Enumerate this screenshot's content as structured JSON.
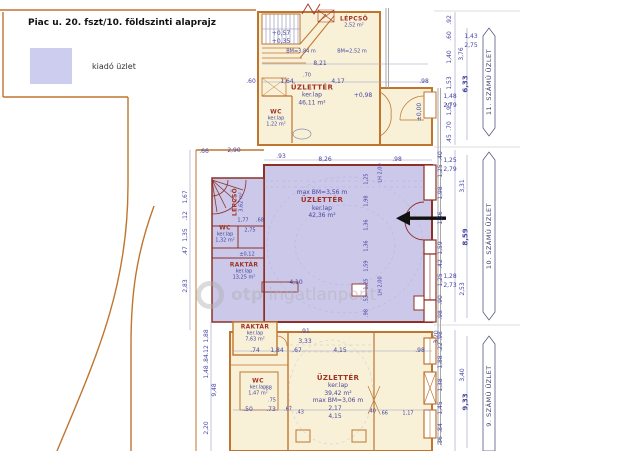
{
  "legend": {
    "title_bold": "Piac u. 20. fszt/10.",
    "title_rest": "földszinti alaprajz",
    "swatch_label": "kiadó üzlet",
    "swatch_color": "#cdcdf0"
  },
  "watermark": {
    "text_bold": "otp",
    "text_rest": "ingatlanpont"
  },
  "colors": {
    "highlight_fill": "#cbc8e9",
    "room_fill": "#f8f1d7",
    "wall_orange": "#c0752f",
    "wall_red": "#8e3026",
    "dim_blue": "#4646a0",
    "room_name_red": "#a03428",
    "facade_gray": "#a0a0a0"
  },
  "side_labels": [
    {
      "t": "11. SZÁMÚ ÜZLET",
      "x": 489,
      "y": 82
    },
    {
      "t": "10. SZÁMÚ ÜZLET",
      "x": 489,
      "y": 236
    },
    {
      "t": "9. SZÁMÚ ÜZLET",
      "x": 489,
      "y": 396
    }
  ],
  "room_labels": [
    {
      "x": 354,
      "y": 22,
      "lines": [
        {
          "t": "LÉPCSŐ",
          "c": "rn t6"
        },
        {
          "t": "2,52 m²",
          "c": "rs t5"
        }
      ]
    },
    {
      "x": 312,
      "y": 95,
      "lines": [
        {
          "t": "ÜZLETTÉR",
          "c": "rn"
        },
        {
          "t": "ker.lap",
          "c": "rs"
        },
        {
          "t": "46,11 m²",
          "c": "rs"
        }
      ]
    },
    {
      "x": 276,
      "y": 118,
      "lines": [
        {
          "t": "WC",
          "c": "rn t6"
        },
        {
          "t": "ker.lap",
          "c": "rs t5"
        },
        {
          "t": "1,22 m²",
          "c": "rs t5"
        }
      ]
    },
    {
      "x": 238,
      "y": 202,
      "r": 1,
      "lines": [
        {
          "t": "LÉPCSŐ",
          "c": "rn t6"
        },
        {
          "t": "3,62 m²",
          "c": "rs t5"
        }
      ]
    },
    {
      "x": 225,
      "y": 234,
      "lines": [
        {
          "t": "WC",
          "c": "rn t6"
        },
        {
          "t": "ker.lap",
          "c": "rs t5"
        },
        {
          "t": "1,32 m²",
          "c": "rs t5"
        }
      ]
    },
    {
      "x": 244,
      "y": 271,
      "lines": [
        {
          "t": "RAKTÁR",
          "c": "rn t6"
        },
        {
          "t": "ker.lap",
          "c": "rs t5"
        },
        {
          "t": "13,25 m²",
          "c": "rs t5"
        }
      ]
    },
    {
      "x": 322,
      "y": 204,
      "lines": [
        {
          "t": "max BM=3,56 m",
          "c": "rs"
        },
        {
          "t": "ÜZLETTÉR",
          "c": "rn"
        },
        {
          "t": "ker.lap",
          "c": "rs"
        },
        {
          "t": "42,36 m²",
          "c": "rs"
        }
      ]
    },
    {
      "x": 255,
      "y": 333,
      "lines": [
        {
          "t": "RAKTÁR",
          "c": "rn t6"
        },
        {
          "t": "ker.lap",
          "c": "rs t5"
        },
        {
          "t": "7,63 m²",
          "c": "rs t5"
        }
      ]
    },
    {
      "x": 258,
      "y": 387,
      "lines": [
        {
          "t": "WC",
          "c": "rn t6"
        },
        {
          "t": "ker.lap",
          "c": "rs t5"
        },
        {
          "t": "1,47 m²",
          "c": "rs t5"
        }
      ]
    },
    {
      "x": 338,
      "y": 389,
      "lines": [
        {
          "t": "ÜZLETTÉR",
          "c": "rn"
        },
        {
          "t": "ker.lap",
          "c": "rs"
        },
        {
          "t": "39,42 m²",
          "c": "rs"
        },
        {
          "t": "max BM=3,06 m",
          "c": "rs"
        }
      ]
    }
  ],
  "dim_labels": [
    {
      "t": "+0,57",
      "x": 281,
      "y": 34
    },
    {
      "t": "+0,35",
      "x": 281,
      "y": 42
    },
    {
      "t": "BM=3,84 m",
      "x": 301,
      "y": 52,
      "k": "t5"
    },
    {
      "t": "BM=2,52 m",
      "x": 352,
      "y": 52,
      "k": "t5"
    },
    {
      "t": "8,21",
      "x": 320,
      "y": 64
    },
    {
      "t": ".60",
      "x": 251,
      "y": 82
    },
    {
      "t": "1,64",
      "x": 287,
      "y": 82
    },
    {
      "t": ".70",
      "x": 307,
      "y": 76,
      "k": "t5"
    },
    {
      "t": "4,17",
      "x": 338,
      "y": 82
    },
    {
      "t": ".98",
      "x": 424,
      "y": 82
    },
    {
      "t": "+0,98",
      "x": 363,
      "y": 96
    },
    {
      "t": "±0,00",
      "x": 420,
      "y": 112,
      "r": 1
    },
    {
      "t": "1,48",
      "x": 450,
      "y": 97
    },
    {
      "t": "2,79",
      "x": 450,
      "y": 106
    },
    {
      "t": "1,43",
      "x": 471,
      "y": 37
    },
    {
      "t": "2,75",
      "x": 471,
      "y": 46
    },
    {
      "t": ".92",
      "x": 450,
      "y": 20,
      "r": 1
    },
    {
      "t": ".60",
      "x": 450,
      "y": 36,
      "r": 1
    },
    {
      "t": "1,40",
      "x": 450,
      "y": 57,
      "r": 1
    },
    {
      "t": "1,53",
      "x": 450,
      "y": 83,
      "r": 1
    },
    {
      "t": "1,95",
      "x": 450,
      "y": 109,
      "r": 1
    },
    {
      "t": ".70",
      "x": 450,
      "y": 126,
      "r": 1
    },
    {
      "t": ".45",
      "x": 450,
      "y": 139,
      "r": 1
    },
    {
      "t": "3,76",
      "x": 462,
      "y": 54,
      "r": 1
    },
    {
      "t": "6,33",
      "x": 466,
      "y": 84,
      "r": 1,
      "k": "t7"
    },
    {
      "t": ".66",
      "x": 204,
      "y": 152
    },
    {
      "t": "2,90",
      "x": 234,
      "y": 151
    },
    {
      "t": ".93",
      "x": 281,
      "y": 157
    },
    {
      "t": "8,26",
      "x": 325,
      "y": 160
    },
    {
      "t": ".98",
      "x": 397,
      "y": 160
    },
    {
      "t": "LH 2,00",
      "x": 381,
      "y": 173,
      "r": 1,
      "k": "t5"
    },
    {
      "t": "LH 2,00",
      "x": 381,
      "y": 286,
      "r": 1,
      "k": "t5"
    },
    {
      "t": "1,67",
      "x": 186,
      "y": 197,
      "r": 1
    },
    {
      "t": ".12",
      "x": 186,
      "y": 216,
      "r": 1
    },
    {
      "t": "1,35",
      "x": 186,
      "y": 235,
      "r": 1
    },
    {
      "t": ".47",
      "x": 186,
      "y": 251,
      "r": 1
    },
    {
      "t": "2,83",
      "x": 186,
      "y": 286,
      "r": 1
    },
    {
      "t": "1,77",
      "x": 243,
      "y": 221,
      "k": "t5"
    },
    {
      "t": ".68",
      "x": 260,
      "y": 221,
      "k": "t5"
    },
    {
      "t": "2,75",
      "x": 250,
      "y": 231,
      "k": "t5"
    },
    {
      "t": "±0,12",
      "x": 247,
      "y": 255,
      "k": "t5"
    },
    {
      "t": "4,10",
      "x": 296,
      "y": 283
    },
    {
      "t": "1,25",
      "x": 367,
      "y": 179,
      "r": 1,
      "k": "t5"
    },
    {
      "t": "1,98",
      "x": 367,
      "y": 201,
      "r": 1,
      "k": "t5"
    },
    {
      "t": "1,36",
      "x": 367,
      "y": 225,
      "r": 1,
      "k": "t5"
    },
    {
      "t": "1,36",
      "x": 367,
      "y": 246,
      "r": 1,
      "k": "t5"
    },
    {
      "t": "1,59",
      "x": 367,
      "y": 266,
      "r": 1,
      "k": "t5"
    },
    {
      "t": "1,25",
      "x": 367,
      "y": 284,
      "r": 1,
      "k": "t5"
    },
    {
      "t": ".53",
      "x": 367,
      "y": 299,
      "r": 1,
      "k": "t5"
    },
    {
      "t": ".98",
      "x": 367,
      "y": 313,
      "r": 1,
      "k": "t5"
    },
    {
      "t": "1,25",
      "x": 450,
      "y": 161
    },
    {
      "t": "2,79",
      "x": 450,
      "y": 170
    },
    {
      "t": "1,28",
      "x": 450,
      "y": 277
    },
    {
      "t": "2,73",
      "x": 450,
      "y": 286
    },
    {
      "t": ".40",
      "x": 441,
      "y": 156,
      "r": 1
    },
    {
      "t": "1,25",
      "x": 441,
      "y": 171,
      "r": 1
    },
    {
      "t": "1,98",
      "x": 441,
      "y": 193,
      "r": 1
    },
    {
      "t": "1,36",
      "x": 441,
      "y": 218,
      "r": 1
    },
    {
      "t": "1,59",
      "x": 441,
      "y": 248,
      "r": 1
    },
    {
      "t": ".42",
      "x": 441,
      "y": 264,
      "r": 1
    },
    {
      "t": "1,25",
      "x": 441,
      "y": 280,
      "r": 1
    },
    {
      "t": ".90",
      "x": 441,
      "y": 300,
      "r": 1
    },
    {
      "t": ".98",
      "x": 441,
      "y": 315,
      "r": 1
    },
    {
      "t": "3,31",
      "x": 463,
      "y": 186,
      "r": 1
    },
    {
      "t": "8,59",
      "x": 466,
      "y": 237,
      "r": 1,
      "k": "t7"
    },
    {
      "t": "2,53",
      "x": 463,
      "y": 289,
      "r": 1
    },
    {
      "t": ".91",
      "x": 305,
      "y": 332
    },
    {
      "t": "3,33",
      "x": 305,
      "y": 342
    },
    {
      "t": ".74",
      "x": 255,
      "y": 351
    },
    {
      "t": "1,84",
      "x": 277,
      "y": 351
    },
    {
      "t": ".67",
      "x": 297,
      "y": 351
    },
    {
      "t": "4,15",
      "x": 340,
      "y": 351
    },
    {
      "t": ".98",
      "x": 420,
      "y": 351
    },
    {
      "t": "3,20",
      "x": 437,
      "y": 337,
      "r": 1
    },
    {
      "t": ".88",
      "x": 268,
      "y": 389,
      "k": "t5"
    },
    {
      "t": ".75",
      "x": 272,
      "y": 401,
      "k": "t5"
    },
    {
      "t": ".50",
      "x": 248,
      "y": 410
    },
    {
      "t": ".73",
      "x": 271,
      "y": 410
    },
    {
      "t": ".67",
      "x": 288,
      "y": 410,
      "k": "t5"
    },
    {
      "t": ".43",
      "x": 300,
      "y": 413,
      "k": "t5"
    },
    {
      "t": "2,17",
      "x": 335,
      "y": 409
    },
    {
      "t": "4,15",
      "x": 335,
      "y": 417
    },
    {
      "t": ".40",
      "x": 372,
      "y": 412,
      "k": "t5"
    },
    {
      "t": ".66",
      "x": 384,
      "y": 414,
      "k": "t5"
    },
    {
      "t": "1,17",
      "x": 408,
      "y": 414,
      "k": "t5"
    },
    {
      "t": "1,88",
      "x": 207,
      "y": 336,
      "r": 1
    },
    {
      "t": ".12",
      "x": 207,
      "y": 350,
      "r": 1
    },
    {
      "t": ".84",
      "x": 207,
      "y": 359,
      "r": 1
    },
    {
      "t": "1,48",
      "x": 207,
      "y": 372,
      "r": 1
    },
    {
      "t": "2,20",
      "x": 207,
      "y": 428,
      "r": 1
    },
    {
      "t": "9,48",
      "x": 215,
      "y": 390,
      "r": 1
    },
    {
      "t": ".98",
      "x": 441,
      "y": 336,
      "r": 1
    },
    {
      "t": ".22",
      "x": 441,
      "y": 347,
      "r": 1
    },
    {
      "t": "1,88",
      "x": 441,
      "y": 362,
      "r": 1
    },
    {
      "t": "1,38",
      "x": 441,
      "y": 385,
      "r": 1
    },
    {
      "t": "1,45",
      "x": 441,
      "y": 408,
      "r": 1
    },
    {
      "t": ".84",
      "x": 441,
      "y": 428,
      "r": 1
    },
    {
      "t": ".36",
      "x": 441,
      "y": 441,
      "r": 1
    },
    {
      "t": "3,40",
      "x": 463,
      "y": 375,
      "r": 1
    },
    {
      "t": "9,33",
      "x": 466,
      "y": 402,
      "r": 1,
      "k": "t7"
    }
  ]
}
